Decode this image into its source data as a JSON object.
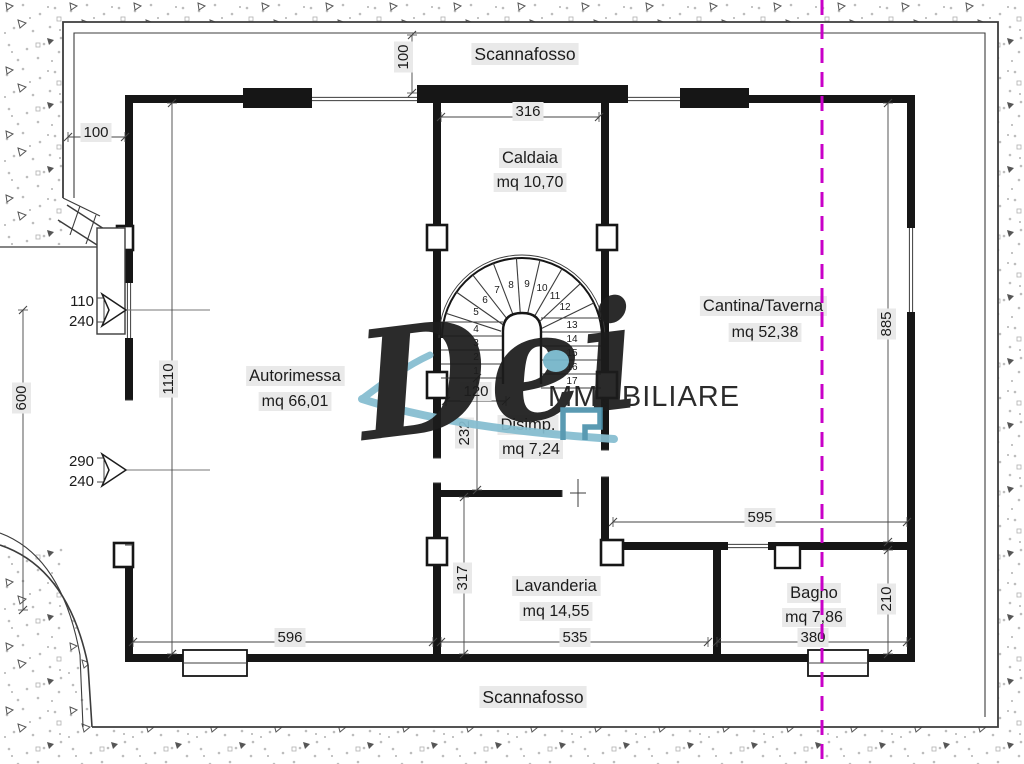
{
  "drawing": {
    "corridor_labels": {
      "top": "Scannafosso",
      "bottom": "Scannafosso"
    },
    "rooms": [
      {
        "id": "caldaia",
        "name": "Caldaia",
        "area": "mq 10,70"
      },
      {
        "id": "cantina",
        "name": "Cantina/Taverna",
        "area": "mq 52,38"
      },
      {
        "id": "autorimessa",
        "name": "Autorimessa",
        "area": "mq 66,01"
      },
      {
        "id": "disimpegno",
        "name": "Disimp.",
        "area": "mq 7,24"
      },
      {
        "id": "lavanderia",
        "name": "Lavanderia",
        "area": "mq 14,55"
      },
      {
        "id": "bagno",
        "name": "Bagno",
        "area": "mq 7,86"
      }
    ],
    "dimensions": [
      {
        "id": "top-offset",
        "value": "100"
      },
      {
        "id": "caldaia-width",
        "value": "316"
      },
      {
        "id": "left-offset",
        "value": "100"
      },
      {
        "id": "left-height",
        "value": "600"
      },
      {
        "id": "garage-height",
        "value": "1110"
      },
      {
        "id": "cantina-height",
        "value": "885"
      },
      {
        "id": "disimpegno-door",
        "value": "120"
      },
      {
        "id": "disimpegno-height",
        "value": "232"
      },
      {
        "id": "lavanderia-height",
        "value": "317"
      },
      {
        "id": "lavanderia-width",
        "value": "535"
      },
      {
        "id": "garage-width",
        "value": "596"
      },
      {
        "id": "cantina-width",
        "value": "595"
      },
      {
        "id": "bagno-height",
        "value": "210"
      },
      {
        "id": "bagno-width",
        "value": "380"
      }
    ],
    "openings": [
      {
        "id": "left-window",
        "width": "110",
        "height": "240"
      },
      {
        "id": "left-door",
        "width": "290",
        "height": "240"
      }
    ],
    "staircase": {
      "step_numbers": [
        "1",
        "2",
        "3",
        "4",
        "5",
        "6",
        "7",
        "8",
        "9",
        "10",
        "11",
        "12",
        "13",
        "14",
        "15",
        "16",
        "17"
      ]
    },
    "watermark": {
      "script": "Dei",
      "brand": "MMOBILIARE"
    },
    "colors": {
      "text": "#1c1c1c",
      "wall": "#161616",
      "line": "#3c3c3c",
      "dim": "#444444",
      "label_bg": "#e9e9e9",
      "section_line": "#c800c8",
      "watermark_script": "#4b4b4b",
      "watermark_brand": "#8f8f8f",
      "watermark_accent": "#85bdd0",
      "watermark_dot": "#74b4c9",
      "watermark_icon": "#4e93ad",
      "stipple_light": "#bdbdbd",
      "stipple_dark": "#565656"
    }
  }
}
